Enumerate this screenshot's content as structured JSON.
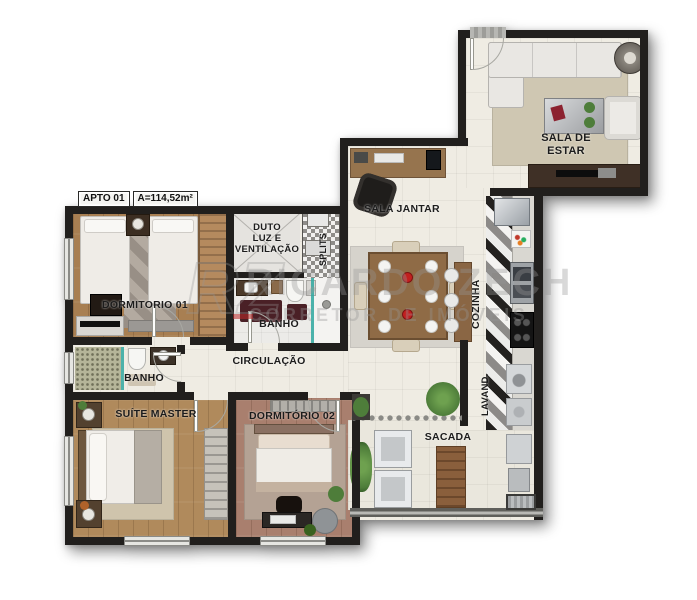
{
  "meta": {
    "apto_tag": "APTO 01",
    "area_tag": "A=114,52m²"
  },
  "rooms": {
    "sala_estar": "SALA DE\nESTAR",
    "sala_jantar": "SALA JANTAR",
    "cozinha": "COZINHA",
    "lavand": "LAVAND.",
    "sacada": "SACADA",
    "dormitorio1": "DORMITORIO 01",
    "dormitorio2": "DORMITÓRIO 02",
    "suite_master": "SUÍTE MASTER",
    "banho_social": "BANHO",
    "banho_suite": "BANHO",
    "circulacao": "CIRCULAÇÃO",
    "duto": "DUTO\nLUZ E\nVENTILAÇÃO",
    "splits": "SPLITS"
  },
  "watermark": {
    "monogram": "RZ",
    "name": "RICARDO ZECH",
    "subtitle": "CORRETOR DE IMÓVEIS"
  },
  "palette": {
    "wall": "#211f1d",
    "floor_cream": "#efece3",
    "floor_balcony": "#eae7dd",
    "wood_warm": "#a87f52",
    "wood_suite": "#b08a5c",
    "wood_rose": "#a97f6e",
    "rug_beige": "#cfc7b2",
    "rug_gray": "#d6d3cc",
    "green_plant": "#4e7d3a",
    "teal_glass": "#2fa8a0",
    "maroon": "#4a2026",
    "label_ink": "#1c1c1c"
  }
}
